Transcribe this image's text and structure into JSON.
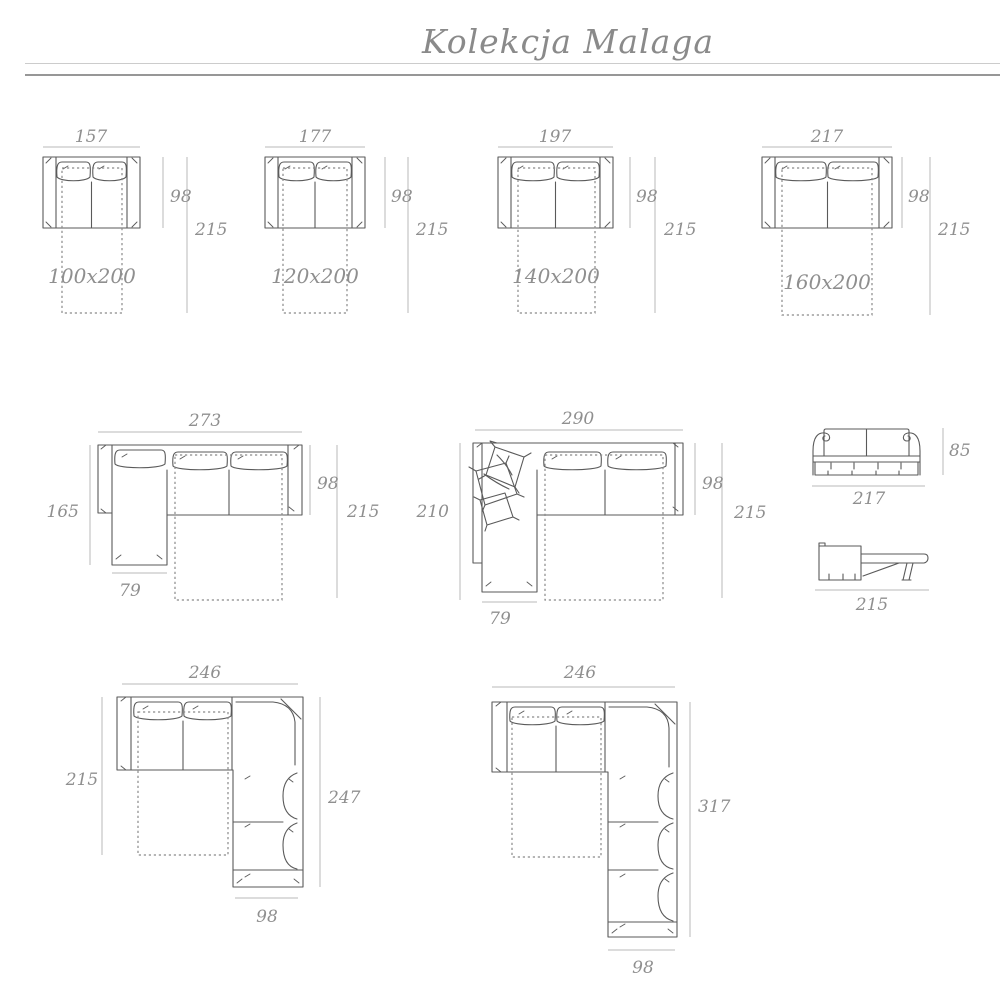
{
  "title": "Kolekcja Malaga",
  "diagrams": {
    "bed100": {
      "width": "157",
      "depth": "98",
      "length": "215",
      "mattress": "100x200"
    },
    "bed120": {
      "width": "177",
      "depth": "98",
      "length": "215",
      "mattress": "120x200"
    },
    "bed140": {
      "width": "197",
      "depth": "98",
      "length": "215",
      "mattress": "140x200"
    },
    "bed160": {
      "width": "217",
      "depth": "98",
      "length": "215",
      "mattress": "160x200"
    },
    "corner165": {
      "width": "273",
      "chaise_length": "165",
      "depth": "98",
      "length": "215",
      "chaise_width": "79"
    },
    "corner210": {
      "width": "290",
      "chaise_length": "210",
      "depth": "98",
      "length": "215",
      "chaise_width": "79"
    },
    "front": {
      "height": "85",
      "width": "217"
    },
    "sideOpen": {
      "length": "215"
    },
    "corner247": {
      "width": "246",
      "side_depth": "215",
      "arm_length": "247",
      "arm_width": "98"
    },
    "corner317": {
      "width": "246",
      "arm_length": "317",
      "arm_width": "98"
    }
  }
}
